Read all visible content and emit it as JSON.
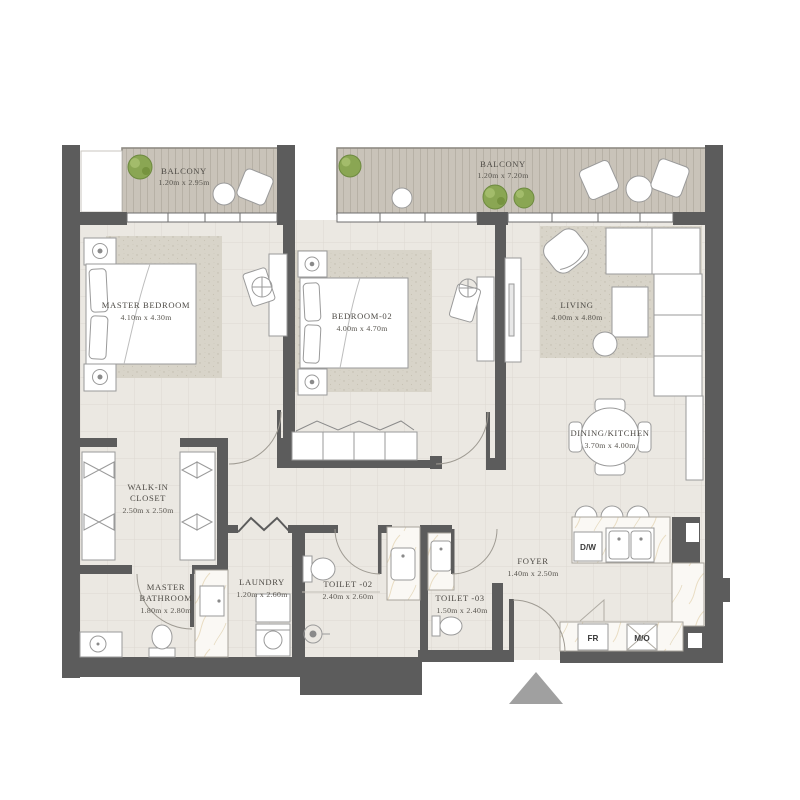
{
  "plan_title": "Apartment Floor Plan",
  "rooms": {
    "balcony1": {
      "name": "BALCONY",
      "dims": "1.20m x 2.95m"
    },
    "balcony2": {
      "name": "BALCONY",
      "dims": "1.20m x 7.20m"
    },
    "master_bedroom": {
      "name": "MASTER BEDROOM",
      "dims": "4.10m x 4.30m"
    },
    "bedroom2": {
      "name": "BEDROOM-02",
      "dims": "4.00m x 4.70m"
    },
    "living": {
      "name": "LIVING",
      "dims": "4.00m x 4.80m"
    },
    "dining_kitchen": {
      "name": "DINING/KITCHEN",
      "dims": "3.70m x 4.00m"
    },
    "walkin_closet": {
      "line1": "WALK-IN",
      "line2": "CLOSET",
      "dims": "2.50m x 2.50m"
    },
    "master_bathroom": {
      "line1": "MASTER",
      "line2": "BATHROOM",
      "dims": "1.80m x 2.80m"
    },
    "laundry": {
      "name": "LAUNDRY",
      "dims": "1.20m x 2.60m"
    },
    "toilet2": {
      "name": "TOILET -02",
      "dims": "2.40m x 2.60m"
    },
    "toilet3": {
      "name": "TOILET -03",
      "dims": "1.50m x 2.40m"
    },
    "foyer": {
      "name": "FOYER",
      "dims": "1.40m x 2.50m"
    }
  },
  "appliances": {
    "dishwasher": "D/W",
    "fridge": "FR",
    "microwave": "M/O"
  },
  "colors": {
    "wall": "#5c5c5c",
    "floor": "#ebe8e2",
    "carpet": "#d8d4c9",
    "deck": "#cac4ba",
    "plant": "#8aa653",
    "entry_arrow": "#a0a0a0",
    "label_text": "#4e4b46"
  }
}
